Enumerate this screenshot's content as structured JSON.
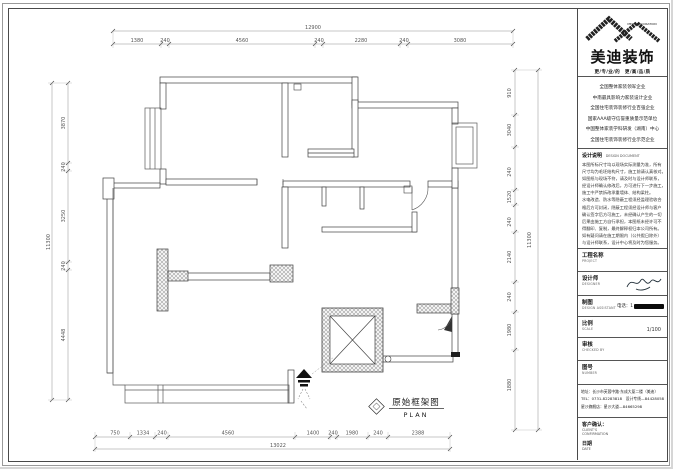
{
  "plan": {
    "label": "原始框架图",
    "label_en": "PLAN",
    "dims": {
      "top": {
        "total": "12900",
        "segments": [
          "1380",
          "240",
          "4560",
          "240",
          "2280",
          "240",
          "3080"
        ]
      },
      "bottom": {
        "total": "13022",
        "segments": [
          "750",
          "1334",
          "240",
          "4560",
          "1400",
          "240",
          "1980",
          "240",
          "2388"
        ]
      },
      "left": {
        "total": "11300",
        "segments": [
          "3870",
          "240",
          "3250",
          "240",
          "4448"
        ]
      },
      "right": {
        "total": "11300",
        "segments": [
          "910",
          "3040",
          "240",
          "1520",
          "240",
          "2140",
          "240",
          "1980",
          "1880"
        ]
      }
    }
  },
  "titleblock": {
    "logo": {
      "brand_en": "MEIDI DECORATION",
      "brand": "美迪装饰",
      "tagline": "更/专/业/的　更/高/品/质"
    },
    "credentials": [
      "全国整体家装领军企业",
      "中南最具影响力家装设计企业",
      "全国住宅装饰装修行业百强企业",
      "国家AAA级守信誉重质量示范单位",
      "中国整体家装学科研发（湖南）中心",
      "全国住宅装饰装修行业示范企业"
    ],
    "notes": {
      "heading": "设计说明",
      "heading_en": "DESIGN DOCUMENT",
      "lines": [
        "本图所标尺寸均以现场实际测量为准，所有",
        "尺寸均为毛坯结构尺寸，施工前请认真核对。",
        "如图纸与现场不符，请及时与设计师联系，",
        "经设计师确认修改后，方可进行下一步施工，",
        "施工中严禁拆改承重墙体、结构梁柱。",
        "水电改造、防水等隐蔽工程须经监理验收合",
        "格后方可封闭，隐蔽工程须经设计师与客户",
        "确认签字后方可施工，未经确认产生的一切",
        "后果由施工方自行承担，本图纸未经许可不",
        "得翻印、复制，最终解释权归本公司所有。",
        "如有疑问请在施工期限内（公共假日除外）",
        "与设计师联系，设计中心将及时为您服务。"
      ]
    },
    "rows": {
      "project_label": "工程名称",
      "project_en": "PROJECT",
      "designer_label": "设计师",
      "designer_en": "DESIGNER",
      "drafter_label": "制图",
      "drafter_en": "DESIGN ASSISTANT",
      "drafter_phone": "电话：1",
      "scale_label": "比例",
      "scale_en": "SCALE",
      "scale_value": "1/100",
      "check_label": "审核",
      "check_en": "CHECKED BY",
      "number_label": "图号",
      "number_en": "NUMBER"
    },
    "address": [
      "地址：长沙市芙蓉中路·东成大厦二楼（美迪）",
      "TEL：0731-82283818　设计专线—84428058",
      "星沙旗舰店：星沙大道—84665298"
    ],
    "footer": [
      "客户确认：",
      "CLIENT'S",
      "CONFIRMATION",
      "日期",
      "DATE"
    ]
  }
}
